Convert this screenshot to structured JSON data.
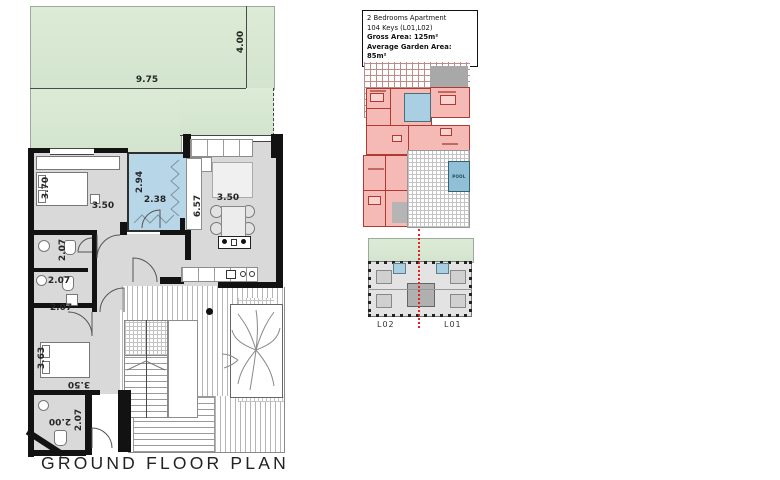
{
  "title": "GROUND FLOOR PLAN",
  "info_box": {
    "line1": "2 Bedrooms Apartment",
    "line2": "104 Keys (L01,L02)",
    "line3": "Gross Area: 125m²",
    "line4": "Average Garden Area: 85m²"
  },
  "main_plan": {
    "dimensions": [
      "9.75",
      "4.00",
      "3.70",
      "3.50",
      "2.94",
      "2.38",
      "6.57",
      "3.50",
      "2.07",
      "2.07",
      "2.07",
      "3.63",
      "3.50",
      "2.00",
      "2.07"
    ]
  },
  "mini_plan": {
    "pool_label": "POOL"
  },
  "key_plan": {
    "left_label": "L02",
    "right_label": "L01"
  },
  "colors": {
    "garden_green": "#d3e4ce",
    "patio_blue": "#b7d7e9",
    "floor_gray": "#d9d9d9",
    "wall_black": "#121212",
    "apartment_pink": "#f5bab6",
    "outline_red": "#b03a31",
    "marker_red": "#e62020",
    "pool_blue": "#8fc0d8"
  }
}
